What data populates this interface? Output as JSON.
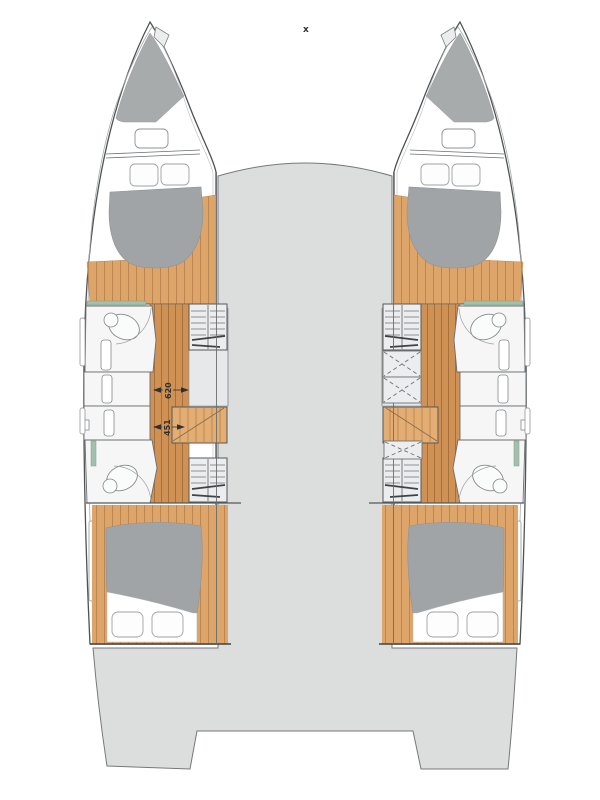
{
  "diagram": {
    "type": "catamaran-floorplan-top-view",
    "annotations": {
      "mast_marker": "x",
      "dimensions": [
        {
          "name": "corridor-width-forward",
          "value": "620"
        },
        {
          "name": "corridor-width-aft",
          "value": "451"
        }
      ]
    },
    "colors": {
      "background": "#ffffff",
      "bridgedeck_gray": "#dcdddd",
      "hull_outline": "#4e5254",
      "bow_deck_gray": "#a8abac",
      "mattress_gray": "#a1a4a6",
      "wood_corridor": "#cf9154",
      "wood_cabin": "#dda56a",
      "wood_plank_line": "#a6703a",
      "stairs_wood": "#e3ae74",
      "closet_fill": "#ecedee",
      "teal_accent": "#a3bfae",
      "fixture_white": "#f6f6f6"
    }
  }
}
